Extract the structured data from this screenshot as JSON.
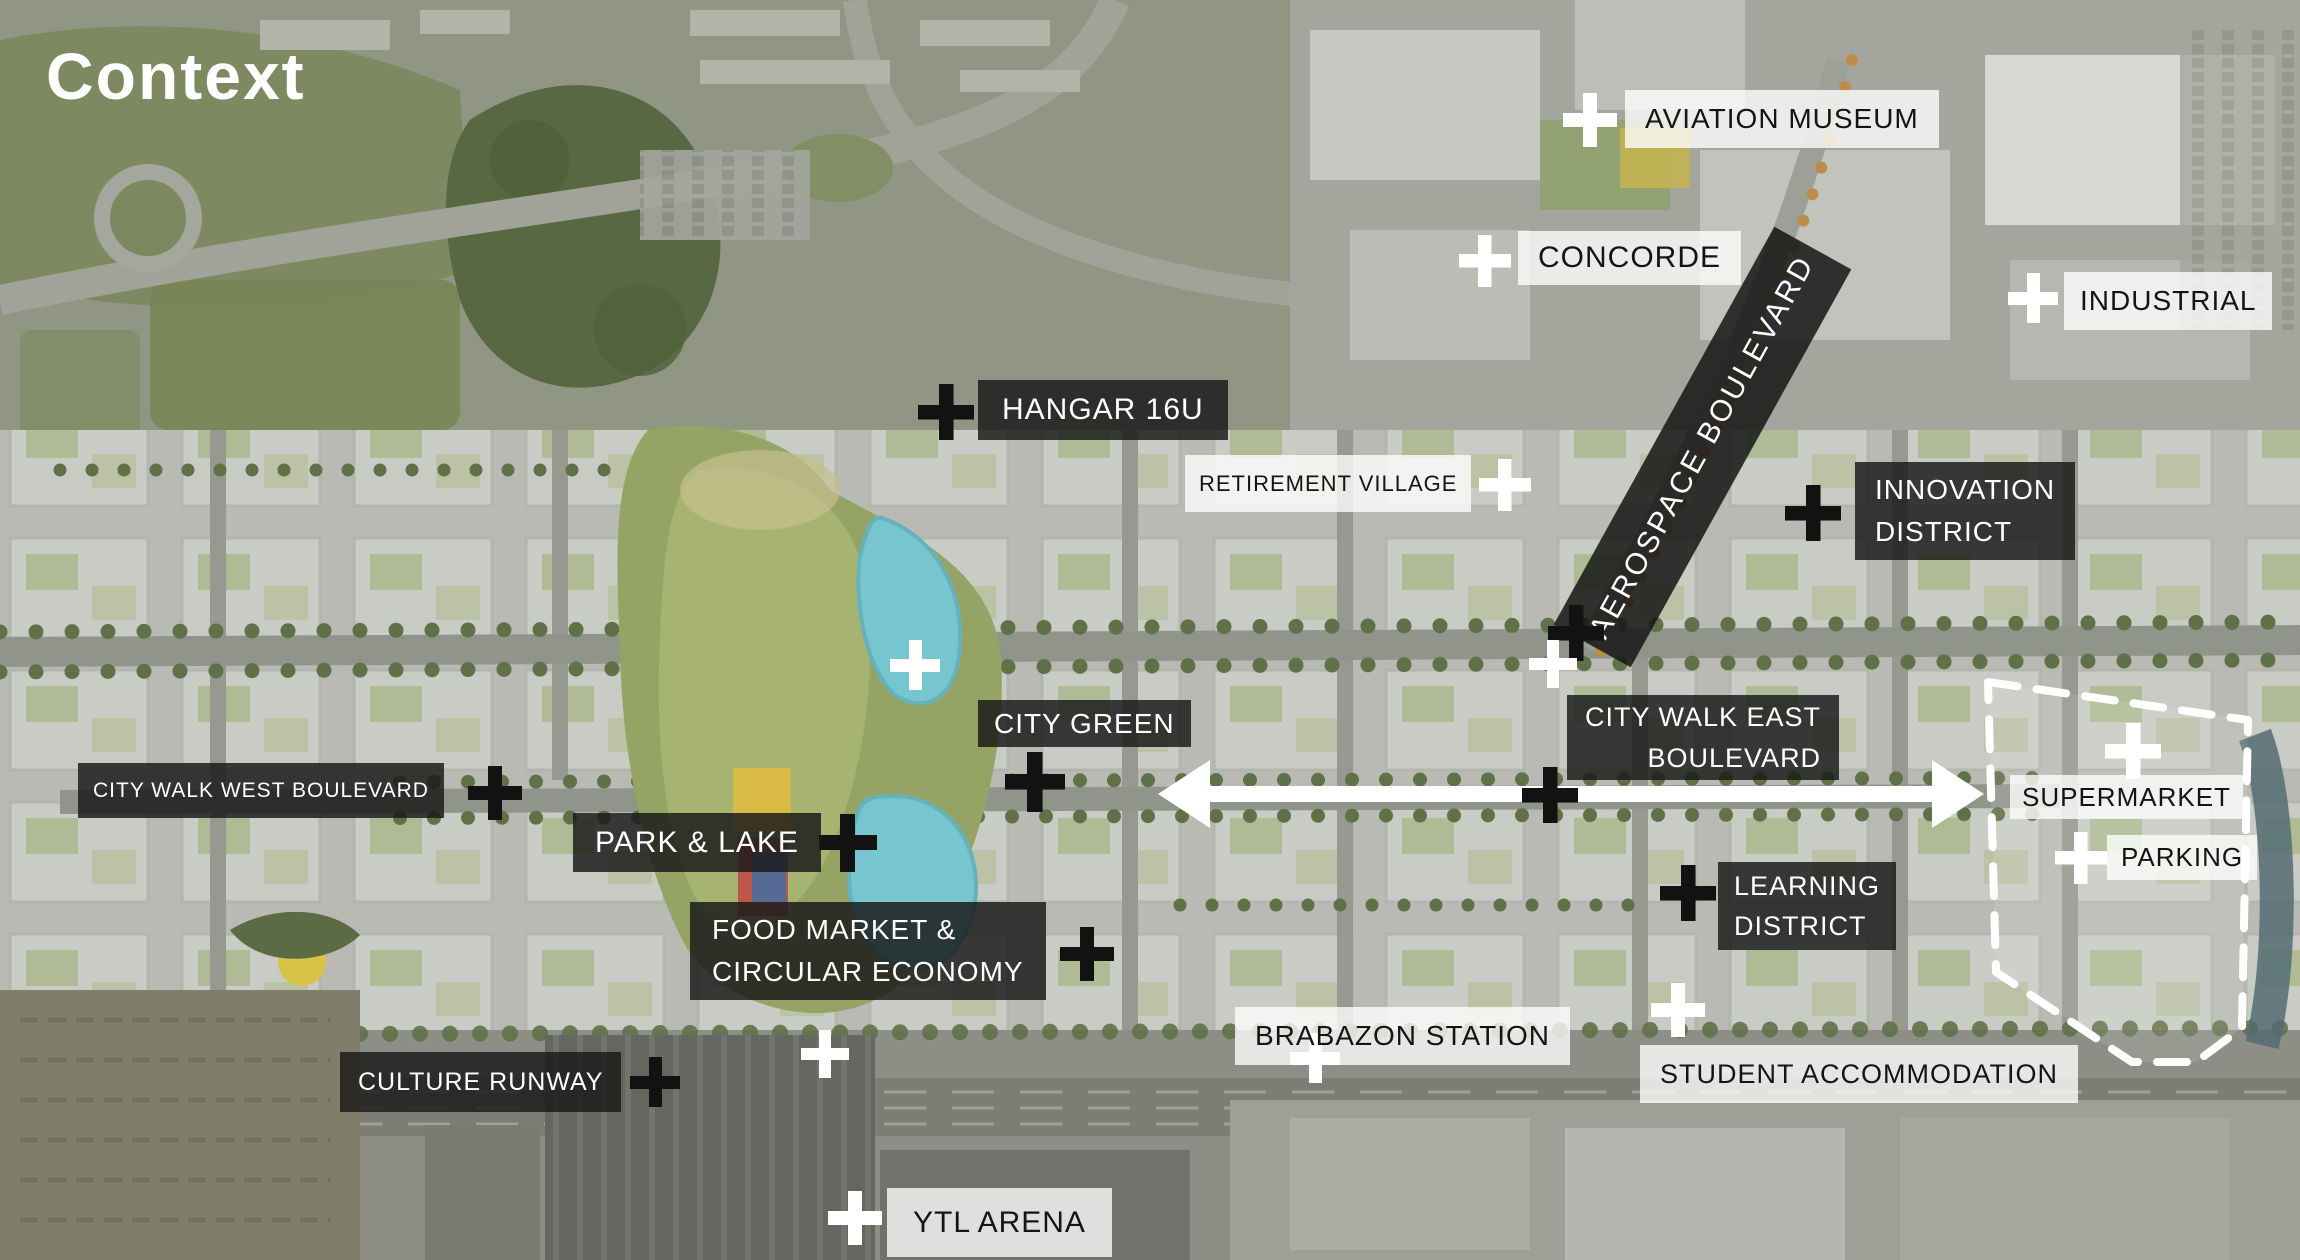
{
  "slide": {
    "title": "Context"
  },
  "colors": {
    "label_dark_bg": "#1a1a1a",
    "label_dark_opacity": "0.84",
    "label_light_bg": "#ffffff",
    "label_light_opacity": "0.78",
    "label_dark_text": "#ffffff",
    "label_light_text": "#141414",
    "marker_black": "#121212",
    "marker_white": "#ffffff",
    "lake_water": "#72c6cf",
    "arrow": "#ffffff",
    "site_outline": "#ffffff"
  },
  "icons": {
    "marker": "plus-icon"
  },
  "labels": {
    "aviation_museum": {
      "text": "AVIATION MUSEUM",
      "style": "light"
    },
    "concorde": {
      "text": "CONCORDE",
      "style": "light"
    },
    "industrial": {
      "text": "INDUSTRIAL",
      "style": "light"
    },
    "hangar_16u": {
      "text": "HANGAR 16U",
      "style": "dark"
    },
    "aerospace_boulevard": {
      "text": "AEROSPACE BOULEVARD",
      "style": "dark-rotated"
    },
    "retirement_village": {
      "text": "RETIREMENT VILLAGE",
      "style": "light"
    },
    "innovation_district": {
      "line1": "INNOVATION",
      "line2": "DISTRICT",
      "style": "dark"
    },
    "city_green": {
      "text": "CITY GREEN",
      "style": "dark"
    },
    "city_walk_east_boulevard": {
      "line1": "CITY WALK EAST",
      "line2": "BOULEVARD",
      "style": "dark"
    },
    "city_walk_west_boulevard": {
      "text": "CITY WALK WEST BOULEVARD",
      "style": "dark"
    },
    "park_and_lake": {
      "text": "PARK & LAKE",
      "style": "dark"
    },
    "supermarket": {
      "text": "SUPERMARKET",
      "style": "light"
    },
    "parking": {
      "text": "PARKING",
      "style": "light"
    },
    "learning_district": {
      "line1": "LEARNING",
      "line2": "DISTRICT",
      "style": "dark"
    },
    "food_market": {
      "line1": "FOOD MARKET &",
      "line2": "CIRCULAR ECONOMY",
      "style": "dark"
    },
    "brabazon_station": {
      "text": "BRABAZON STATION",
      "style": "light"
    },
    "student_accommodation": {
      "text": "STUDENT ACCOMMODATION",
      "style": "light"
    },
    "culture_runway": {
      "text": "CULTURE RUNWAY",
      "style": "dark"
    },
    "ytl_arena": {
      "text": "YTL ARENA",
      "style": "light"
    }
  },
  "markers": {
    "aviation_museum": "white",
    "concorde": "white",
    "industrial": "white",
    "hangar_16u": "black",
    "retirement_village": "white",
    "innovation_district": "black",
    "aerospace_junction_black": "black",
    "aerospace_junction_white": "white",
    "city_centre_white": "white",
    "city_green": "black",
    "city_walk_west": "black",
    "city_walk_east": "black",
    "park_and_lake": "black",
    "supermarket": "white",
    "parking": "white",
    "learning_district": "black",
    "food_market": "black",
    "brabazon_station": "white",
    "student_accommodation": "white",
    "culture_runway": "black",
    "culture_area_white": "white",
    "ytl_arena": "white"
  },
  "graphics": {
    "boulevard_arrow": {
      "type": "double-headed",
      "color": "#ffffff"
    },
    "supermarket_site_outline": {
      "style": "dashed",
      "color": "#ffffff"
    }
  }
}
